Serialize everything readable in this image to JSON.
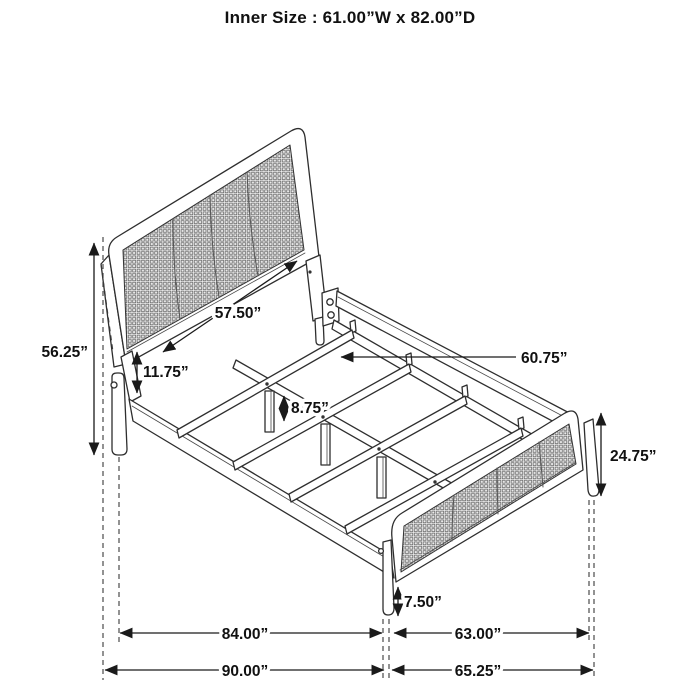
{
  "title": "Inner Size : 61.00”W x 82.00”D",
  "dimensions": {
    "headboard_height": "56.25”",
    "headboard_inner_width": "57.50”",
    "headboard_bottom_gap": "11.75”",
    "support_leg_height": "8.75”",
    "slat_length": "60.75”",
    "footboard_height": "24.75”",
    "footboard_ground_clearance": "7.50”",
    "inner_length": "84.00”",
    "inner_foot_width": "63.00”",
    "overall_length": "90.00”",
    "overall_width": "65.25”"
  }
}
